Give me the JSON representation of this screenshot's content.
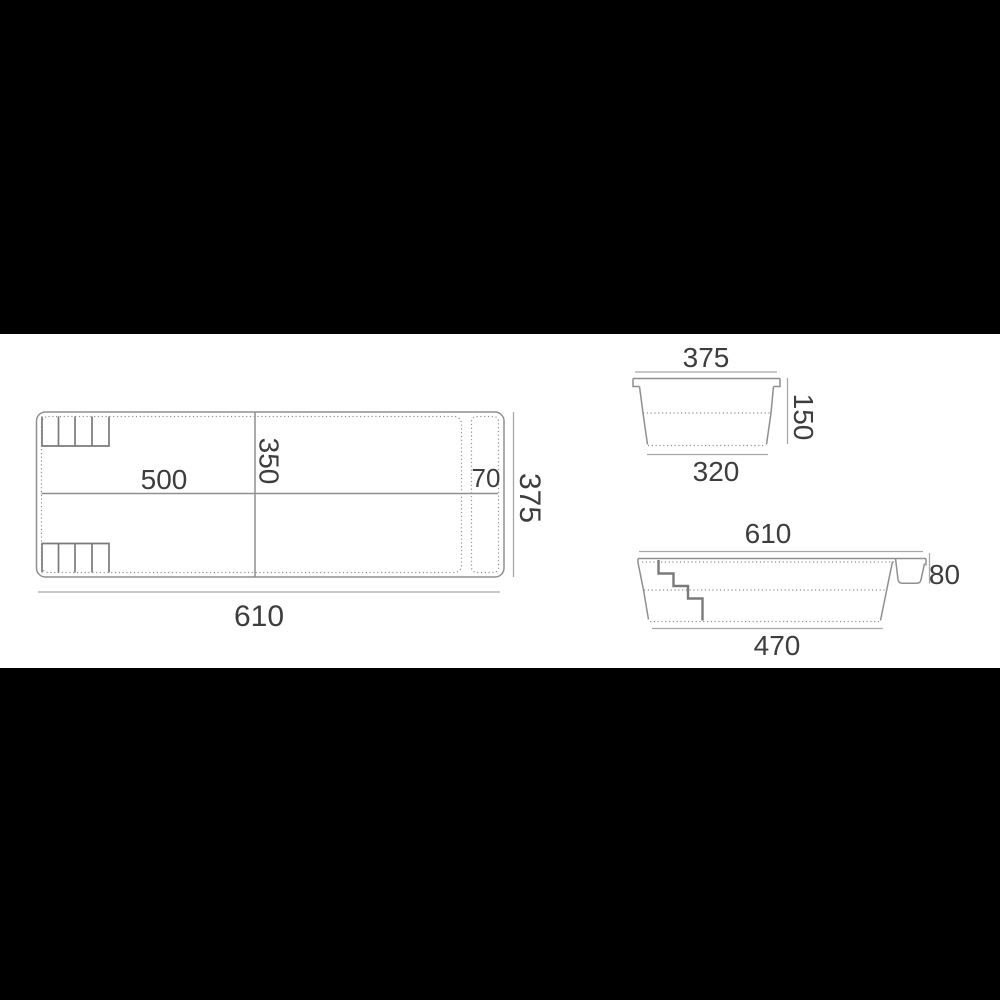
{
  "page": {
    "background": "#ffffff",
    "letterbox_color": "#000000"
  },
  "drawing": {
    "type": "technical-drawing",
    "subject": "rectangular-pool-shell-dimensioned-views",
    "colors": {
      "line": "#8f8f8f",
      "dim_line": "#a8a8a8",
      "steps_line": "#7a7a7a",
      "text": "#3d3d3d"
    },
    "views": {
      "plan": {
        "dim_inner_length": "500",
        "dim_inner_width": "350",
        "dim_bench_width": "70",
        "dim_overall_width": "375",
        "dim_overall_length": "610"
      },
      "end_section": {
        "dim_top_width": "375",
        "dim_depth": "150",
        "dim_bottom_width": "320"
      },
      "side_section": {
        "dim_top_length": "610",
        "dim_shallow_depth": "80",
        "dim_bottom_length": "470"
      }
    }
  }
}
